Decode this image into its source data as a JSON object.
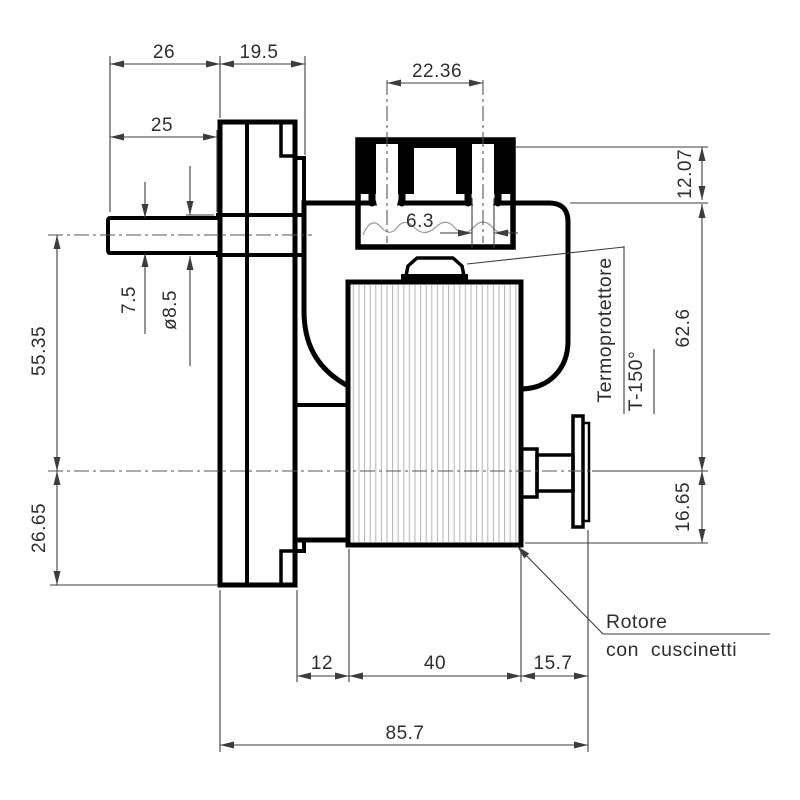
{
  "drawing": {
    "annotations": {
      "thermal": {
        "line1": "Termoprotettore",
        "line2": "T-150°"
      },
      "rotor": {
        "line1": "Rotore",
        "line2": "con cuscinetti"
      }
    },
    "dims": {
      "d26": "26",
      "d19_5": "19.5",
      "d25": "25",
      "d22_36": "22.36",
      "d6_3": "6.3",
      "d12_07": "12.07",
      "d62_6": "62.6",
      "d7_5": "7.5",
      "d8_5": "ø8.5",
      "d55_35": "55.35",
      "d26_65": "26.65",
      "d16_65": "16.65",
      "d12": "12",
      "d40": "40",
      "d15_7": "15.7",
      "d85_7": "85.7"
    }
  }
}
